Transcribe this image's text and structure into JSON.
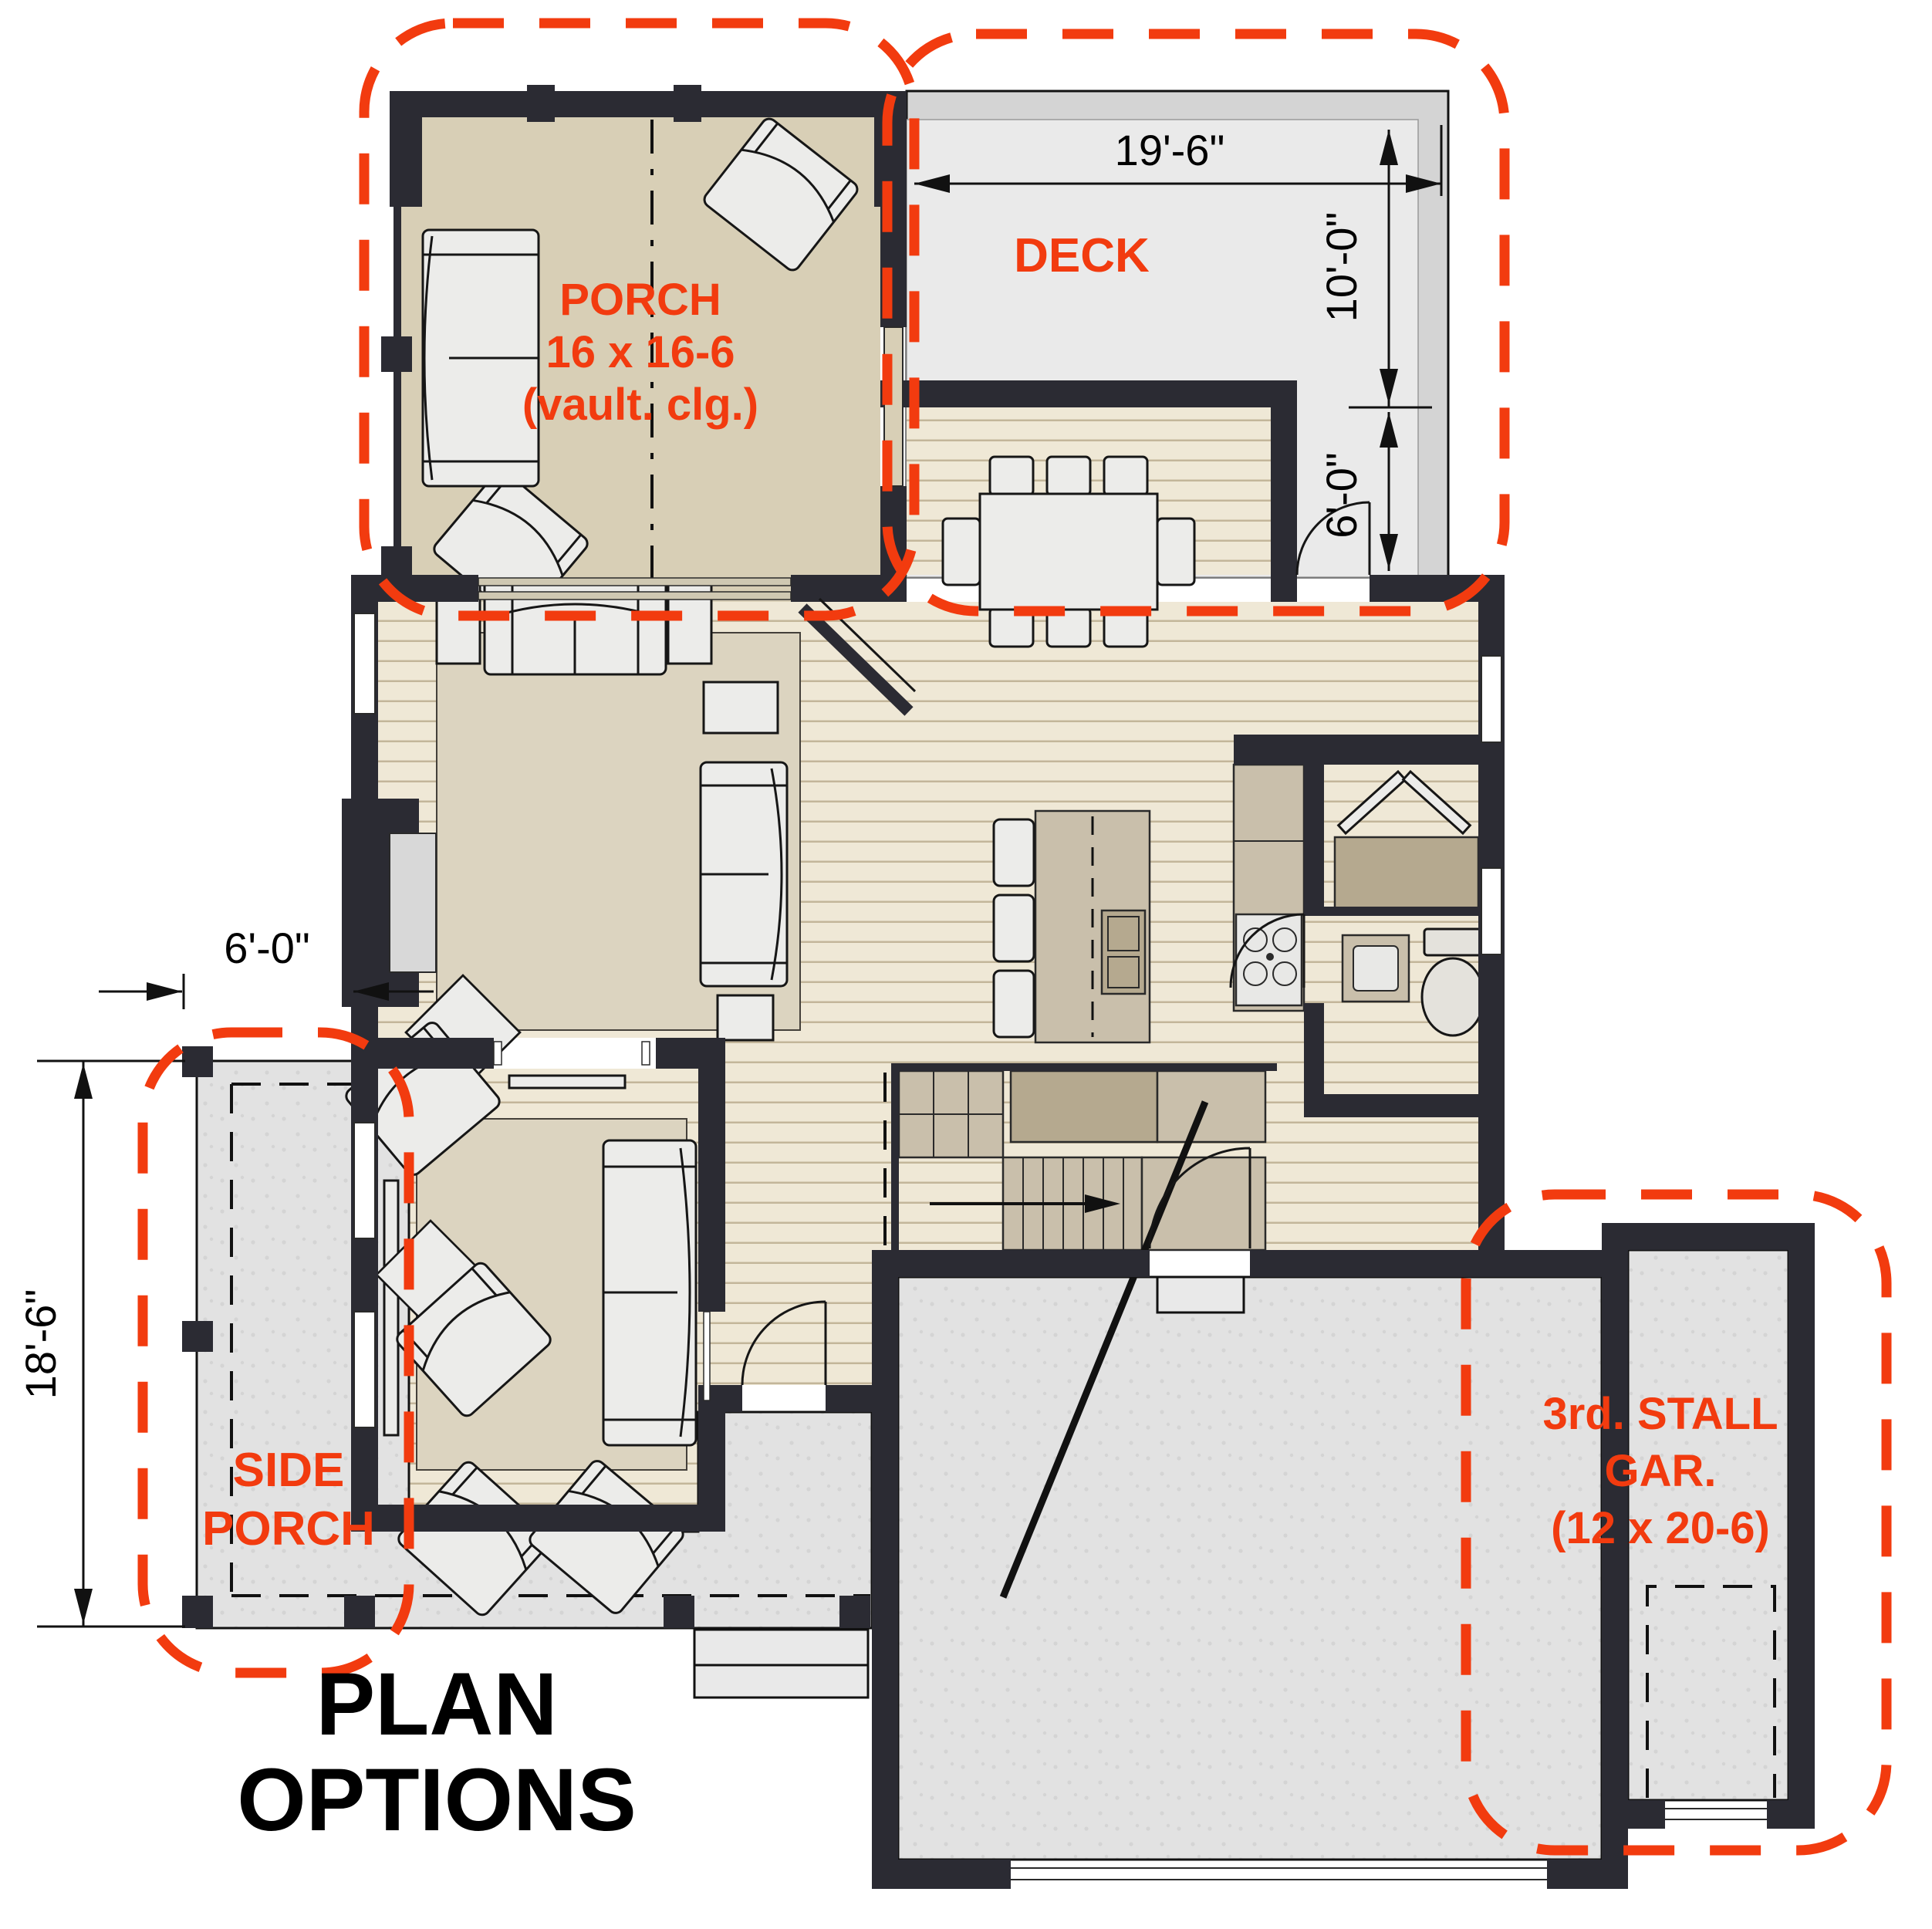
{
  "title": {
    "line1": "PLAN",
    "line2": "OPTIONS"
  },
  "options": {
    "porch": {
      "label_line1": "PORCH",
      "label_line2": "16 x 16-6",
      "label_line3": "(vault. clg.)"
    },
    "deck": {
      "label": "DECK",
      "dim_width": "19'-6\"",
      "dim_depth": "10'-0\"",
      "dim_inset": "6'-0\""
    },
    "side_porch": {
      "label_line1": "SIDE",
      "label_line2": "PORCH",
      "dim_offset": "6'-0\"",
      "dim_depth": "18'-6\""
    },
    "third_stall_garage": {
      "label_line1": "3rd. STALL",
      "label_line2": "GAR.",
      "label_line3": "(12 x 20-6)"
    }
  },
  "colors": {
    "wall": "#2b2b33",
    "wood": "#efe8d6",
    "stripe": "#c3b69a",
    "tan": "#d8cfb6",
    "rug": "#dcd4c0",
    "slab": "#e2e2e2",
    "deck": "#eaeaea",
    "rim": "#d4d4d4",
    "counter": "#c9bfab",
    "cabinet": "#b5a98f",
    "furn": "#ececea",
    "line": "#161616",
    "red": "#f23b0f"
  }
}
